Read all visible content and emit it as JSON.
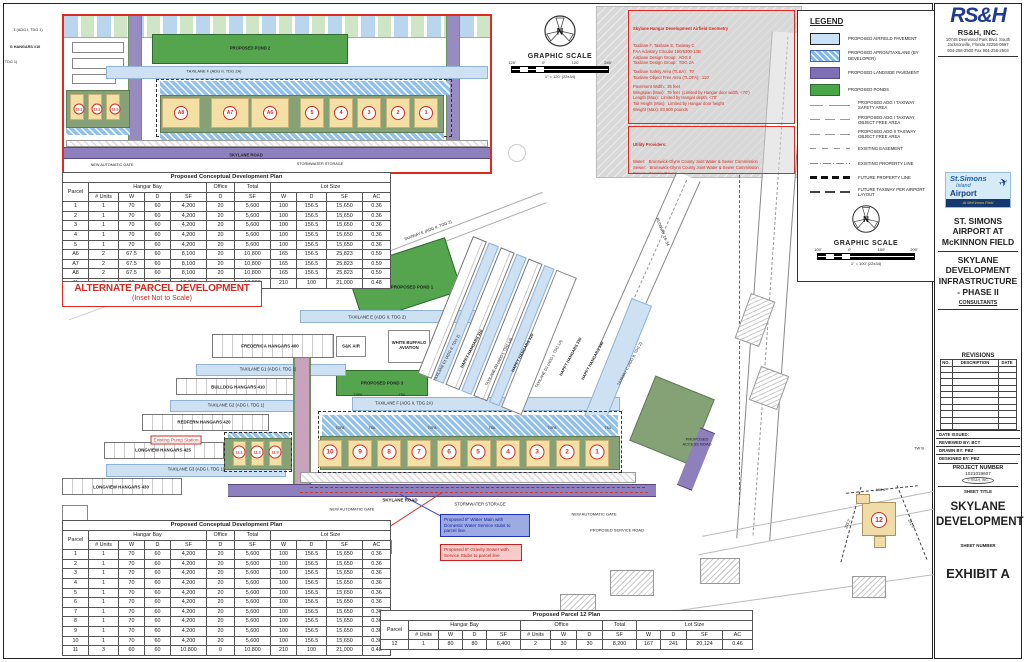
{
  "colors": {
    "red_accent": "#d12c23",
    "airfield_blue": "#c9e0f5",
    "apron_blue": "#7fb8e8",
    "landside_purple": "#7e6fb5",
    "pond_green": "#4aa448",
    "parcel_tan": "#f4dfa4",
    "logo_blue": "#1e3b8e"
  },
  "headers_note": "column headers shared by development tables",
  "alt_table": {
    "title": "Proposed Conceptual Development Plan",
    "col1": "Parcel",
    "groups": [
      {
        "label": "Hangar Bay",
        "span": 4
      },
      {
        "label": "Office",
        "span": 1
      },
      {
        "label": "Total",
        "span": 1
      },
      {
        "label": "Lot Size",
        "span": 4
      }
    ],
    "subheads": [
      "# Units",
      "W",
      "D",
      "SF",
      "D",
      "SF",
      "W",
      "D",
      "SF",
      "AC"
    ],
    "rows": [
      [
        "1",
        "1",
        "70",
        "60",
        "4,200",
        "20",
        "5,600",
        "100",
        "156.5",
        "15,650",
        "0.36"
      ],
      [
        "2",
        "1",
        "70",
        "60",
        "4,200",
        "20",
        "5,600",
        "100",
        "156.5",
        "15,650",
        "0.36"
      ],
      [
        "3",
        "1",
        "70",
        "60",
        "4,200",
        "20",
        "5,600",
        "100",
        "156.5",
        "15,650",
        "0.36"
      ],
      [
        "4",
        "1",
        "70",
        "60",
        "4,200",
        "20",
        "5,600",
        "100",
        "156.5",
        "15,650",
        "0.36"
      ],
      [
        "5",
        "1",
        "70",
        "60",
        "4,200",
        "20",
        "5,600",
        "100",
        "156.5",
        "15,650",
        "0.36"
      ],
      [
        "A6",
        "2",
        "67.5",
        "60",
        "8,100",
        "20",
        "10,800",
        "165",
        "156.5",
        "25,823",
        "0.59"
      ],
      [
        "A7",
        "2",
        "67.5",
        "60",
        "8,100",
        "20",
        "10,800",
        "165",
        "156.5",
        "25,823",
        "0.59"
      ],
      [
        "A8",
        "2",
        "67.5",
        "60",
        "8,100",
        "20",
        "10,800",
        "165",
        "156.5",
        "25,823",
        "0.59"
      ],
      [
        "11",
        "3",
        "60",
        "60",
        "10,800",
        "0",
        "10,800",
        "210",
        "100",
        "21,000",
        "0.48"
      ]
    ]
  },
  "banner": {
    "line1": "ALTERNATE PARCEL DEVELOPMENT",
    "line2": "(Inset Not to Scale)"
  },
  "main_table": {
    "title": "Proposed Conceptual Development Plan",
    "col1": "Parcel",
    "groups": [
      {
        "label": "Hangar Bay",
        "span": 4
      },
      {
        "label": "Office",
        "span": 1
      },
      {
        "label": "Total",
        "span": 1
      },
      {
        "label": "Lot Size",
        "span": 4
      }
    ],
    "subheads": [
      "# Units",
      "W",
      "D",
      "SF",
      "D",
      "SF",
      "W",
      "D",
      "SF",
      "AC"
    ],
    "rows": [
      [
        "1",
        "1",
        "70",
        "60",
        "4,200",
        "20",
        "5,600",
        "100",
        "156.5",
        "15,650",
        "0.36"
      ],
      [
        "2",
        "1",
        "70",
        "60",
        "4,200",
        "20",
        "5,600",
        "100",
        "156.5",
        "15,650",
        "0.36"
      ],
      [
        "3",
        "1",
        "70",
        "60",
        "4,200",
        "20",
        "5,600",
        "100",
        "156.5",
        "15,650",
        "0.36"
      ],
      [
        "4",
        "1",
        "70",
        "60",
        "4,200",
        "20",
        "5,600",
        "100",
        "156.5",
        "15,650",
        "0.36"
      ],
      [
        "5",
        "1",
        "70",
        "60",
        "4,200",
        "20",
        "5,600",
        "100",
        "156.5",
        "15,650",
        "0.36"
      ],
      [
        "6",
        "1",
        "70",
        "60",
        "4,200",
        "20",
        "5,600",
        "100",
        "156.5",
        "15,650",
        "0.36"
      ],
      [
        "7",
        "1",
        "70",
        "60",
        "4,200",
        "20",
        "5,600",
        "100",
        "156.5",
        "15,650",
        "0.36"
      ],
      [
        "8",
        "1",
        "70",
        "60",
        "4,200",
        "20",
        "5,600",
        "100",
        "156.5",
        "15,650",
        "0.36"
      ],
      [
        "9",
        "1",
        "70",
        "60",
        "4,200",
        "20",
        "5,600",
        "100",
        "156.5",
        "15,650",
        "0.36"
      ],
      [
        "10",
        "1",
        "70",
        "60",
        "4,200",
        "20",
        "5,600",
        "100",
        "156.5",
        "15,650",
        "0.36"
      ],
      [
        "11",
        "3",
        "60",
        "60",
        "10,800",
        "0",
        "10,800",
        "210",
        "100",
        "21,000",
        "0.48"
      ]
    ]
  },
  "p12_table": {
    "title": "Proposed Parcel 12 Plan",
    "col1": "Parcel",
    "groups": [
      {
        "label": "Hangar Bay",
        "span": 4
      },
      {
        "label": "Office",
        "span": 3
      },
      {
        "label": "Total",
        "span": 1
      },
      {
        "label": "Lot Size",
        "span": 4
      }
    ],
    "subheads": [
      "# Units",
      "W",
      "D",
      "SF",
      "# Units",
      "W",
      "D",
      "SF",
      "W",
      "D",
      "SF",
      "AC"
    ],
    "rows": [
      [
        "12",
        "1",
        "80",
        "80",
        "6,400",
        "2",
        "30",
        "30",
        "8,200",
        "167",
        "241",
        "20,124",
        "0.46"
      ]
    ]
  },
  "geometry_box": {
    "title": "Skylane Hangar Development Airfield Geometry",
    "lines": [
      "Taxilane F, Taxilane E, Taxiway C",
      "FAA Advisory Circular 150/5300-13B",
      "Airplane Design Group:  ADG II",
      "Taxilane Design Group:  TDG 2A",
      "",
      "Taxilane Safety Area (TLSA):  79'",
      "Taxilane Object Free Area (TLOFA):  110'",
      "",
      "Pavement Width:  35 feet",
      "Wingspan (Max):  79 feet  (Limited by Hangar door width, <70')",
      "Length (Max):  Limited by Hangar depth, <70'",
      "Tail Height (Max):  Limited by Hangar door height",
      "Weight (Max): 83,500 pounds"
    ]
  },
  "utility_box": {
    "title": "Utility Providers:",
    "lines": [
      "Water:   Brunswick-Glynn County Joint Water & Sewer Commission",
      "Sewer:   Brunswick-Glynn County Joint Water & Sewer Commission",
      "Power:  Georgia Power",
      "Comm:  ATT",
      "             Comcast of Greater Florida/Georgia",
      "             Live Oak Fiber",
      "Gas:      Atlanta Gas & Light"
    ]
  },
  "legend": {
    "title": "LEGEND",
    "items": [
      {
        "type": "sw-air",
        "label": "PROPOSED AIRFIELD PAVEMENT"
      },
      {
        "type": "sw-apron",
        "label": "PROPOSED APRON/TAXILANE (BY DEVELOPER)"
      },
      {
        "type": "sw-land",
        "label": "PROPOSED LANDSIDE PAVEMENT"
      },
      {
        "type": "sw-pond",
        "label": "PROPOSED PONDS"
      },
      {
        "type": "ln-tsa",
        "label": "PROPOSED ADG I TAXIWAY SAFETY AREA"
      },
      {
        "type": "ln-tofa",
        "label": "PROPOSED ADG I TAXIWAY OBJECT FREE AREA"
      },
      {
        "type": "ln-tofa",
        "label": "PROPOSED ADG II TAXIWAY OBJECT FREE AREA"
      },
      {
        "type": "ln-ease",
        "label": "EXISTING EASEMENT"
      },
      {
        "type": "ln-eprop",
        "label": "EXISTING PROPERTY LINE"
      },
      {
        "type": "ln-fprop",
        "label": "FUTURE PROPERTY LINE"
      },
      {
        "type": "ln-ftaxi",
        "label": "FUTURE TAXIWAY PER AIRPORT LAYOUT"
      }
    ]
  },
  "scale1": {
    "title": "GRAPHIC SCALE",
    "labels": [
      "120'",
      "0'",
      "120'",
      "240'"
    ],
    "note": "1\" = 120' (22x34)"
  },
  "scale2": {
    "title": "GRAPHIC SCALE",
    "labels": [
      "100'",
      "0'",
      "100'",
      "200'"
    ],
    "note": "1\" = 100' (22x34)"
  },
  "titleblock": {
    "rs_logo": "RS&H",
    "rs_name": "RS&H, INC.",
    "rs_addr": "10748 Deerwood Park Blvd. South\nJacksonville, Florida 32256-0597\n904-256-2500 Fax 904-256-2503",
    "logo_l1": "St.Simons",
    "logo_l2": "Island",
    "logo_l3": "Airport",
    "logo_field": "At McKinnon Field",
    "airport_name": "ST. SIMONS\nAIRPORT AT\nMcKINNON FIELD",
    "project_title": "SKYLANE\nDEVELOPMENT\nINFRASTRUCTURE\n- PHASE II",
    "consultants": "CONSULTANTS",
    "revisions": {
      "title": "REVISIONS",
      "cols": [
        "NO.",
        "DESCRIPTION",
        "DATE"
      ],
      "empty_rows": 10
    },
    "issued": [
      "DATE ISSUED:",
      "REVIEWED BY:  BCT",
      "DRAWN BY:  PBZ",
      "DESIGNED BY:  PBZ"
    ],
    "project_number_label": "PROJECT NUMBER",
    "project_number": "1021019607",
    "copyright": "© RS&H, INC.",
    "sheet_title_label": "SHEET TITLE",
    "sheet_title": "SKYLANE\nDEVELOPMENT",
    "sheet_number_label": "SHEET NUMBER",
    "sheet_number": "EXHIBIT A"
  },
  "plan": {
    "pump_label": "Existing Pump Station",
    "water_note": "Proposed 8\" Water Main with\nDomestic Water Service stubs to\nparcel line.",
    "sewer_note": "Proposed 8\" Gravity Sewer with\nService Stubs to parcel line",
    "labels": [
      {
        "t": "TAXILANE E (ADG II, TDG 2)",
        "x": 377,
        "y": 317,
        "f": 4.4
      },
      {
        "t": "FREDERICA HANGARS 400",
        "x": 270,
        "y": 346,
        "c": "b",
        "f": 4.4
      },
      {
        "t": "S&K AIR",
        "x": 351,
        "y": 346,
        "c": "b",
        "f": 4.4
      },
      {
        "t": "WHITE BUFFALO\nAVIATION",
        "x": 409,
        "y": 346,
        "c": "b",
        "f": 4.2
      },
      {
        "t": "TAXILANE G1 (ADG I, TDG 1)",
        "x": 268,
        "y": 370,
        "f": 4.2
      },
      {
        "t": "BULLDOG HANGARS 410",
        "x": 238,
        "y": 387,
        "c": "b",
        "f": 4.4
      },
      {
        "t": "TAXILANE G2 (ADG I, TDG 1)",
        "x": 236,
        "y": 406,
        "f": 4.2
      },
      {
        "t": "REDFERN HANGARS 420",
        "x": 204,
        "y": 422,
        "c": "b",
        "f": 4.4
      },
      {
        "t": "LONGVIEW HANGARS 425",
        "x": 163,
        "y": 450,
        "c": "b",
        "f": 4.4
      },
      {
        "t": "TAXILANE G3 (ADG I, TDG 1)",
        "x": 196,
        "y": 470,
        "f": 4.2
      },
      {
        "t": "LONGVIEW HANGARS 430",
        "x": 121,
        "y": 487,
        "c": "b",
        "f": 4.4
      },
      {
        "t": "PROPOSED POND 1",
        "x": 412,
        "y": 287,
        "c": "b",
        "f": 4.4
      },
      {
        "t": "PROPOSED POND 3",
        "x": 382,
        "y": 383,
        "c": "b",
        "f": 4.4
      },
      {
        "t": "TAXILANE F (ADG II, TDG 2A)",
        "x": 404,
        "y": 404,
        "f": 4.2
      },
      {
        "t": "SKYLANE ROAD",
        "x": 400,
        "y": 500,
        "c": "b",
        "f": 4.4
      },
      {
        "t": "STORMWATER STORAGE",
        "x": 480,
        "y": 505,
        "f": 4.2
      },
      {
        "t": "NEW AUTOMATIC GATE",
        "x": 352,
        "y": 510,
        "f": 4
      },
      {
        "t": "NEW AUTOMATIC GATE",
        "x": 594,
        "y": 515,
        "f": 4
      },
      {
        "t": "PROPOSED SERVICE ROAD",
        "x": 617,
        "y": 531,
        "f": 4
      },
      {
        "t": "PROPOSED\nACCESS ROAD",
        "x": 697,
        "y": 442,
        "f": 4
      },
      {
        "t": "TAXILANE E1 (ADG II, TDG 2)",
        "x": 447,
        "y": 358,
        "r": -62,
        "f": 3.8
      },
      {
        "t": "HAPPY HANGARS 310",
        "x": 472,
        "y": 349,
        "r": -62,
        "c": "b",
        "f": 4
      },
      {
        "t": "TAXILANE D2 (ADG I, TDG 1A)",
        "x": 499,
        "y": 362,
        "r": -62,
        "f": 3.8
      },
      {
        "t": "HAPPY HANGARS 320",
        "x": 523,
        "y": 353,
        "r": -62,
        "c": "b",
        "f": 4
      },
      {
        "t": "TAXILANE D1 (ADG I, TDG 1A)",
        "x": 549,
        "y": 364,
        "r": -62,
        "f": 3.8
      },
      {
        "t": "HAPPY HANGARS 330",
        "x": 571,
        "y": 357,
        "r": -62,
        "c": "b",
        "f": 4
      },
      {
        "t": "HAPPY HANGARS 340",
        "x": 593,
        "y": 361,
        "r": -62,
        "c": "b",
        "f": 4
      },
      {
        "t": "TAXIWAY C (ADG II, TDG 2)",
        "x": 630,
        "y": 364,
        "r": -62,
        "f": 3.8
      },
      {
        "t": "TAXIWAY E (ADG II, TDG 2)",
        "x": 428,
        "y": 231,
        "r": -21,
        "f": 4
      },
      {
        "t": "RUNWAY 16-34",
        "x": 662,
        "y": 232,
        "r": 68,
        "f": 4.2
      },
      {
        "t": "TW B",
        "x": 919,
        "y": 449,
        "f": 4
      },
      {
        "t": "166.6'",
        "x": 881,
        "y": 490,
        "f": 3.8
      },
      {
        "t": "293.2'",
        "x": 848,
        "y": 524,
        "r": -68,
        "f": 3.8
      },
      {
        "t": "241.0'",
        "x": 911,
        "y": 524,
        "r": 62,
        "f": 3.8
      },
      {
        "t": "TOFA",
        "x": 340,
        "y": 429,
        "f": 3.4
      },
      {
        "t": "TSA",
        "x": 372,
        "y": 429,
        "f": 3.4
      },
      {
        "t": "TOFA",
        "x": 432,
        "y": 429,
        "f": 3.4
      },
      {
        "t": "TSA",
        "x": 492,
        "y": 429,
        "f": 3.4
      },
      {
        "t": "TOFA",
        "x": 552,
        "y": 429,
        "f": 3.4
      },
      {
        "t": "TSA",
        "x": 608,
        "y": 429,
        "f": 3.4
      },
      {
        "t": "TOFA",
        "x": 358,
        "y": 396,
        "f": 3.4
      },
      {
        "t": "TSA",
        "x": 402,
        "y": 396,
        "f": 3.4
      },
      {
        "t": "1 (ADG I, TDG 1)",
        "x": 28,
        "y": 30,
        "f": 3.8
      },
      {
        "t": "G HANGARS #10",
        "x": 25,
        "y": 47,
        "c": "b",
        "f": 3.8
      },
      {
        "t": "TDG 1)",
        "x": 11,
        "y": 62,
        "f": 3.8
      }
    ],
    "circles": [
      {
        "t": "10",
        "x": 330,
        "y": 452,
        "s": 15,
        "f": 6.5
      },
      {
        "t": "9",
        "x": 360,
        "y": 452,
        "s": 15,
        "f": 6.5
      },
      {
        "t": "8",
        "x": 389,
        "y": 452,
        "s": 15,
        "f": 6.5
      },
      {
        "t": "7",
        "x": 419,
        "y": 452,
        "s": 15,
        "f": 6.5
      },
      {
        "t": "6",
        "x": 449,
        "y": 452,
        "s": 15,
        "f": 6.5
      },
      {
        "t": "5",
        "x": 478,
        "y": 452,
        "s": 15,
        "f": 6.5
      },
      {
        "t": "4",
        "x": 508,
        "y": 452,
        "s": 15,
        "f": 6.5
      },
      {
        "t": "3",
        "x": 537,
        "y": 452,
        "s": 15,
        "f": 6.5
      },
      {
        "t": "2",
        "x": 567,
        "y": 452,
        "s": 15,
        "f": 6.5
      },
      {
        "t": "1",
        "x": 597,
        "y": 452,
        "s": 15,
        "f": 6.5
      },
      {
        "t": "11.1",
        "x": 239,
        "y": 452,
        "s": 13,
        "f": 4
      },
      {
        "t": "11.2",
        "x": 257,
        "y": 452,
        "s": 13,
        "f": 4
      },
      {
        "t": "11.3",
        "x": 275,
        "y": 452,
        "s": 13,
        "f": 4
      },
      {
        "t": "12",
        "x": 879,
        "y": 520,
        "s": 16,
        "f": 7
      }
    ]
  },
  "inset": {
    "labels": [
      {
        "t": "PROPOSED POND 2",
        "x": 186,
        "y": 33,
        "c": "b",
        "f": 4.2
      },
      {
        "t": "TAXILANE F (ADG II, TDG 2A)",
        "x": 150,
        "y": 56,
        "f": 4
      },
      {
        "t": "SKYLANE ROAD",
        "x": 182,
        "y": 140,
        "c": "b",
        "f": 4.2
      },
      {
        "t": "NEW AUTOMATIC GATE",
        "x": 48,
        "y": 149,
        "f": 3.8
      },
      {
        "t": "STORMWATER STORAGE",
        "x": 256,
        "y": 148,
        "f": 3.8
      }
    ],
    "circles": [
      {
        "t": "11.1",
        "x": 15,
        "y": 93,
        "s": 11,
        "f": 3.6
      },
      {
        "t": "11.2",
        "x": 33,
        "y": 93,
        "s": 11,
        "f": 3.6
      },
      {
        "t": "11.3",
        "x": 51,
        "y": 93,
        "s": 11,
        "f": 3.6
      },
      {
        "t": "A8",
        "x": 117,
        "y": 97,
        "s": 14,
        "f": 5
      },
      {
        "t": "A7",
        "x": 166,
        "y": 97,
        "s": 14,
        "f": 5
      },
      {
        "t": "A6",
        "x": 206,
        "y": 97,
        "s": 14,
        "f": 5
      },
      {
        "t": "5",
        "x": 248,
        "y": 97,
        "s": 14,
        "f": 5.5
      },
      {
        "t": "4",
        "x": 277,
        "y": 97,
        "s": 14,
        "f": 5.5
      },
      {
        "t": "3",
        "x": 305,
        "y": 97,
        "s": 14,
        "f": 5.5
      },
      {
        "t": "2",
        "x": 334,
        "y": 97,
        "s": 14,
        "f": 5.5
      },
      {
        "t": "1",
        "x": 362,
        "y": 97,
        "s": 14,
        "f": 5.5
      }
    ]
  }
}
